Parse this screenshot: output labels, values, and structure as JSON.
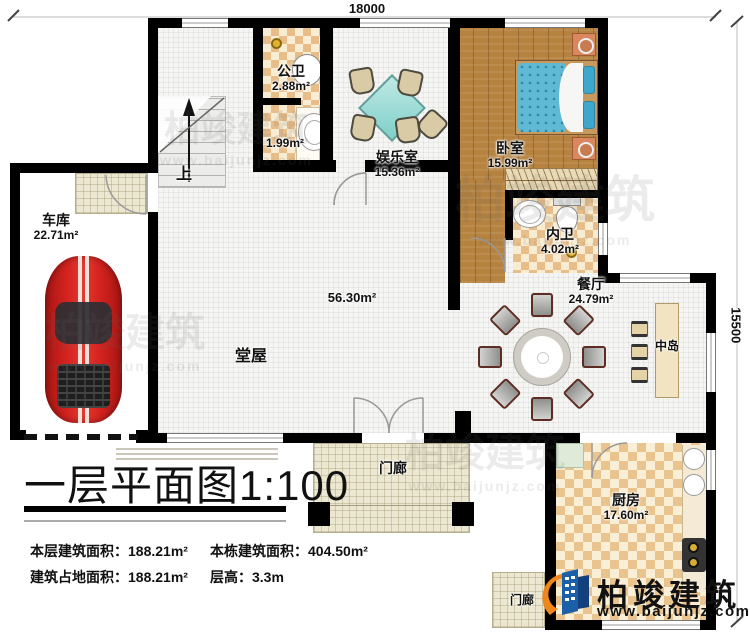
{
  "dimensions": {
    "top": "18000",
    "right": "15500"
  },
  "stairs": {
    "up_label": "上"
  },
  "rooms": {
    "garage": {
      "name": "车库",
      "area": "22.71m²"
    },
    "public_bath": {
      "name": "公卫",
      "area": "2.88m²"
    },
    "washroom": {
      "area": "1.99m²"
    },
    "entertainment": {
      "name": "娱乐室",
      "area": "15.36m²"
    },
    "bedroom": {
      "name": "卧室",
      "area": "15.99m²"
    },
    "ensuite_bath": {
      "name": "内卫",
      "area": "4.02m²"
    },
    "dining": {
      "name": "餐厅",
      "area": "24.79m²"
    },
    "island": {
      "name": "中岛"
    },
    "hall": {
      "name": "堂屋",
      "area": "56.30m²"
    },
    "kitchen": {
      "name": "厨房",
      "area": "17.60m²"
    },
    "porch_front": {
      "name": "门廊"
    },
    "porch_side": {
      "name": "门廊"
    }
  },
  "title": {
    "text": "一层平面图",
    "scale": "1:100"
  },
  "info": {
    "floor_area_label": "本层建筑面积：",
    "floor_area_value": "188.21m²",
    "footprint_label": "建筑占地面积：",
    "footprint_value": "188.21m²",
    "building_area_label": "本栋建筑面积：",
    "building_area_value": "404.50m²",
    "storey_height_label": "层高：",
    "storey_height_value": "3.3m"
  },
  "branding": {
    "company": "柏竣建筑",
    "website": "www.baijunjz.com"
  },
  "watermark": {
    "text": "柏竣建筑",
    "url": "www.baijunjz.com"
  },
  "colors": {
    "wall": "#000000",
    "bed_teal": "#5fb8d4",
    "car_red": "#cc1f1d",
    "logo_blue": "#1a5fa8",
    "logo_orange": "#f08519",
    "checker_tan": "#e7bd8a",
    "wood": "#b5823f"
  }
}
